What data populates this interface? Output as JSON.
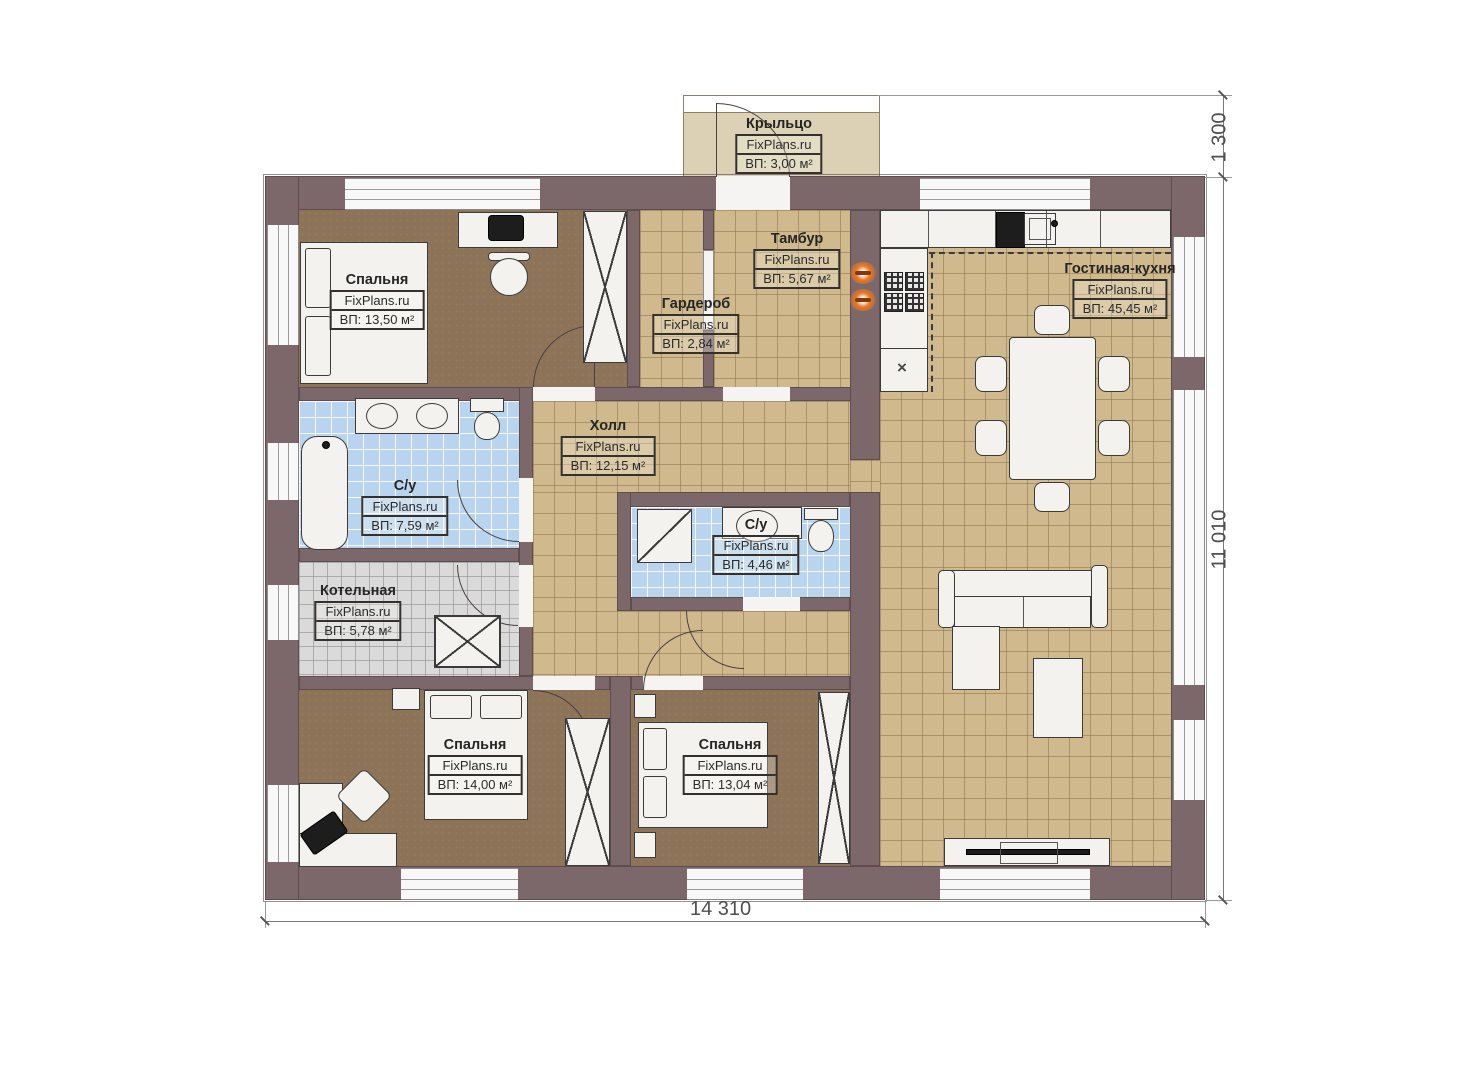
{
  "brand": "FixPlans.ru",
  "rooms": {
    "porch": {
      "name": "Крыльцо",
      "area": "ВП: 3,00 м²"
    },
    "tambour": {
      "name": "Тамбур",
      "area": "ВП: 5,67 м²"
    },
    "wardrobe": {
      "name": "Гардероб",
      "area": "ВП: 2,84 м²"
    },
    "bedroom1": {
      "name": "Спальня",
      "area": "ВП: 13,50 м²"
    },
    "living_kitchen": {
      "name": "Гостиная-кухня",
      "area": "ВП: 45,45 м²"
    },
    "hall": {
      "name": "Холл",
      "area": "ВП: 12,15 м²"
    },
    "bathroom_main": {
      "name": "С/у",
      "area": "ВП: 7,59 м²"
    },
    "boiler": {
      "name": "Котельная",
      "area": "ВП: 5,78 м²"
    },
    "bedroom2": {
      "name": "Спальня",
      "area": "ВП: 14,00 м²"
    },
    "bedroom3": {
      "name": "Спальня",
      "area": "ВП: 13,04 м²"
    },
    "bathroom_small": {
      "name": "С/у",
      "area": "ВП: 4,46 м²"
    }
  },
  "dimensions": {
    "bottom": "14 310",
    "right": "11 010",
    "porch": "1 300"
  },
  "glyphs": {
    "cabinet_cross": "×"
  },
  "colors": {
    "wall": "#7c686b",
    "floor_tan": "#cfb98d",
    "floor_brown": "#8d7458",
    "floor_blue": "#b9d4ee",
    "floor_gray": "#dadada",
    "porch": "#dcd1b5",
    "heater_accent": "#f07820"
  }
}
